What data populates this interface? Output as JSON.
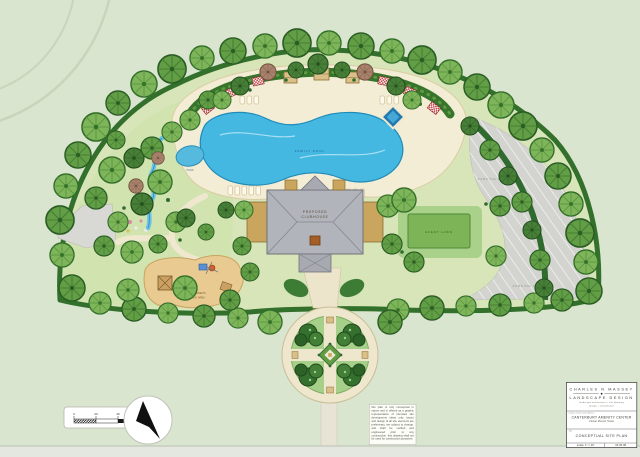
{
  "plan": {
    "labels": {
      "family_pool": "FAMILY POOL",
      "event_lawn": "EVENT LAWN",
      "parking_lot_upper": "PARKING LOT",
      "parking_lot_lower": "PARKING LOT",
      "clubhouse_line1": "PROPOSED",
      "clubhouse_line2": "CLUBHOUSE",
      "play_area_line1": "CHILDREN'S",
      "play_area_line2": "PLAY AREA",
      "pond": "POND"
    },
    "scale_bar": {
      "tick0": "0",
      "tick1": "20",
      "tick2": "40",
      "tick3": "80 FT"
    }
  },
  "disclaimer": "this plan is only conceptual in nature and is offered as a graphic representation of intended site development ideas only. layout and design of all site elements are preliminary, are subject to change, and shall be verified and engineered prior to any construction. this drawing shall not be used for construction purposes.",
  "title_block": {
    "firm_line1": "CHARLES N MASSEY",
    "firm_line2": "LANDSCAPE DESIGN",
    "firm_sub1": "landscape architecture + site planning",
    "firm_sub2": "design + consultation",
    "logo_glyph": "◆",
    "project_label": "project name and address",
    "project_name": "CANTERBURY AMENITY CENTER",
    "project_location": "Flower Mound, Texas",
    "title_label": "title",
    "sheet_title": "CONCEPTUAL SITE PLAN",
    "scale_text": "scale: 1\" = 20'",
    "date_text": "03.05.08"
  },
  "colors": {
    "sheet_bg": "#d9e5cf",
    "site_green": "#d7e5b8",
    "pool_blue": "#45b8e2",
    "deck_cream": "#f4edd6",
    "lawn_green": "#7db457",
    "parking_gray": "#d3d4cf",
    "hedge_green": "#33702c",
    "roof_gray": "#b2b4bb",
    "sand_tan": "#e9cb92"
  }
}
